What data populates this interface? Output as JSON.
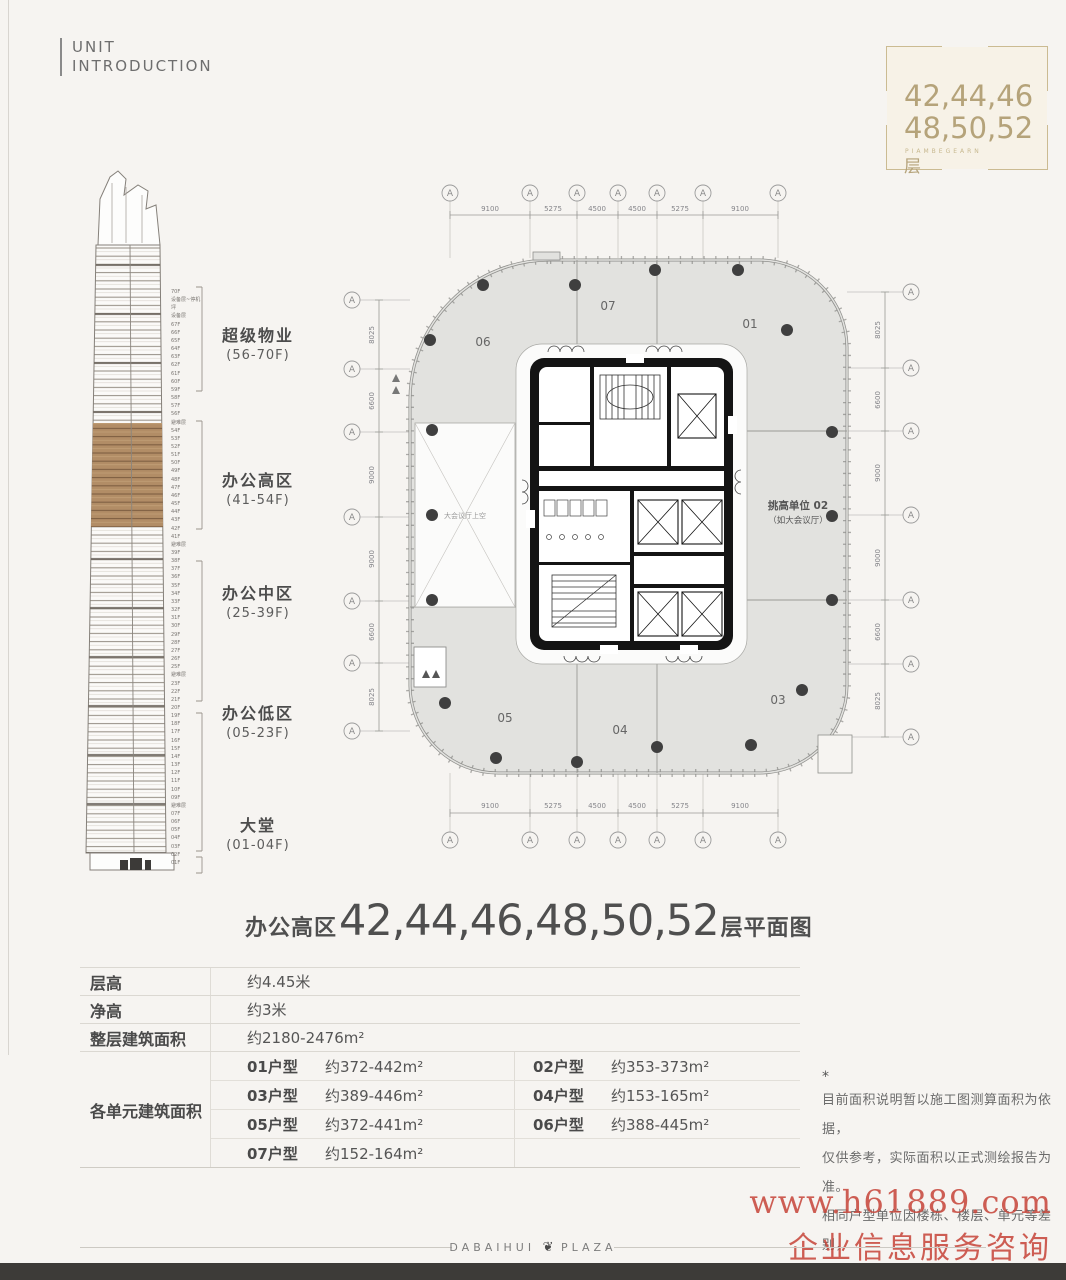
{
  "header": {
    "title_line1": "UNIT",
    "title_line2": "INTRODUCTION"
  },
  "floor_badge": {
    "line1": "42,44,46",
    "line2": "48,50,52",
    "floor_suffix": "层",
    "caption": "PIAMBEGEARN",
    "accent_color": "#b5a37a"
  },
  "elevation": {
    "sections": [
      {
        "name": "超级物业",
        "range": "(56-70F)"
      },
      {
        "name": "办公高区",
        "range": "(41-54F)"
      },
      {
        "name": "办公中区",
        "range": "(25-39F)"
      },
      {
        "name": "办公低区",
        "range": "(05-23F)"
      },
      {
        "name": "大堂",
        "range": "(01-04F)"
      }
    ],
    "floor_labels": "70F\n设备层~停机坪\n设备层\n67F\n66F\n65F\n64F\n63F\n62F\n61F\n60F\n59F\n58F\n57F\n56F\n避难层\n54F\n53F\n52F\n51F\n50F\n49F\n48F\n47F\n46F\n45F\n44F\n43F\n42F\n41F\n避难层\n39F\n38F\n37F\n36F\n35F\n34F\n33F\n32F\n31F\n30F\n29F\n28F\n27F\n26F\n25F\n避难层\n23F\n22F\n21F\n20F\n19F\n18F\n17F\n16F\n15F\n14F\n13F\n12F\n11F\n10F\n09F\n避难层\n07F\n06F\n05F\n04F\n03F\n02F\n01F",
    "highlight_color": "#b28d66"
  },
  "floor_plan": {
    "axis_letter": "A",
    "dims": {
      "h": [
        "9100",
        "5275",
        "4500",
        "4500",
        "5275",
        "9100"
      ],
      "v": [
        "8025",
        "6600",
        "9000",
        "9000",
        "6600",
        "8025"
      ]
    },
    "units": {
      "u01": "01",
      "u03": "03",
      "u04": "04",
      "u05": "05",
      "u06": "06",
      "u07": "07"
    },
    "annotation": {
      "line1": "挑高单位 02",
      "line2": "（如大会议厅）"
    },
    "void_label": "大会议厅上空",
    "fill_color": "#e2e2df",
    "core_color": "#141414"
  },
  "plan_title": {
    "prefix": "办公高区",
    "floors": "42,44,46,48,50,52",
    "suffix": "层平面图"
  },
  "spec_table": {
    "rows": [
      {
        "label": "层高",
        "value": "约4.45米"
      },
      {
        "label": "净高",
        "value": "约3米"
      },
      {
        "label": "整层建筑面积",
        "value": "约2180-2476m²"
      }
    ],
    "units_label": "各单元建筑面积",
    "units": [
      {
        "type": "01户型",
        "area": "约372-442m²"
      },
      {
        "type": "02户型",
        "area": "约353-373m²"
      },
      {
        "type": "03户型",
        "area": "约389-446m²"
      },
      {
        "type": "04户型",
        "area": "约153-165m²"
      },
      {
        "type": "05户型",
        "area": "约372-441m²"
      },
      {
        "type": "06户型",
        "area": "约388-445m²"
      },
      {
        "type": "07户型",
        "area": "约152-164m²"
      }
    ]
  },
  "disclaimer": {
    "mark": "*",
    "lines": [
      "目前面积说明暂以施工图测算面积为依据，",
      "仅供参考，实际面积以正式测绘报告为准。",
      "相同户型单位因楼栋、楼层、单元等差别，",
      "外轮廓、局部结构、面积等可能不同。"
    ]
  },
  "watermark": {
    "line1": "www.h61889.com",
    "line2": "企业信息服务咨询",
    "color": "#c8483c"
  },
  "footer": {
    "brand_left": "DABAIHUI",
    "brand_right": "PLAZA",
    "leaf": "❦"
  }
}
